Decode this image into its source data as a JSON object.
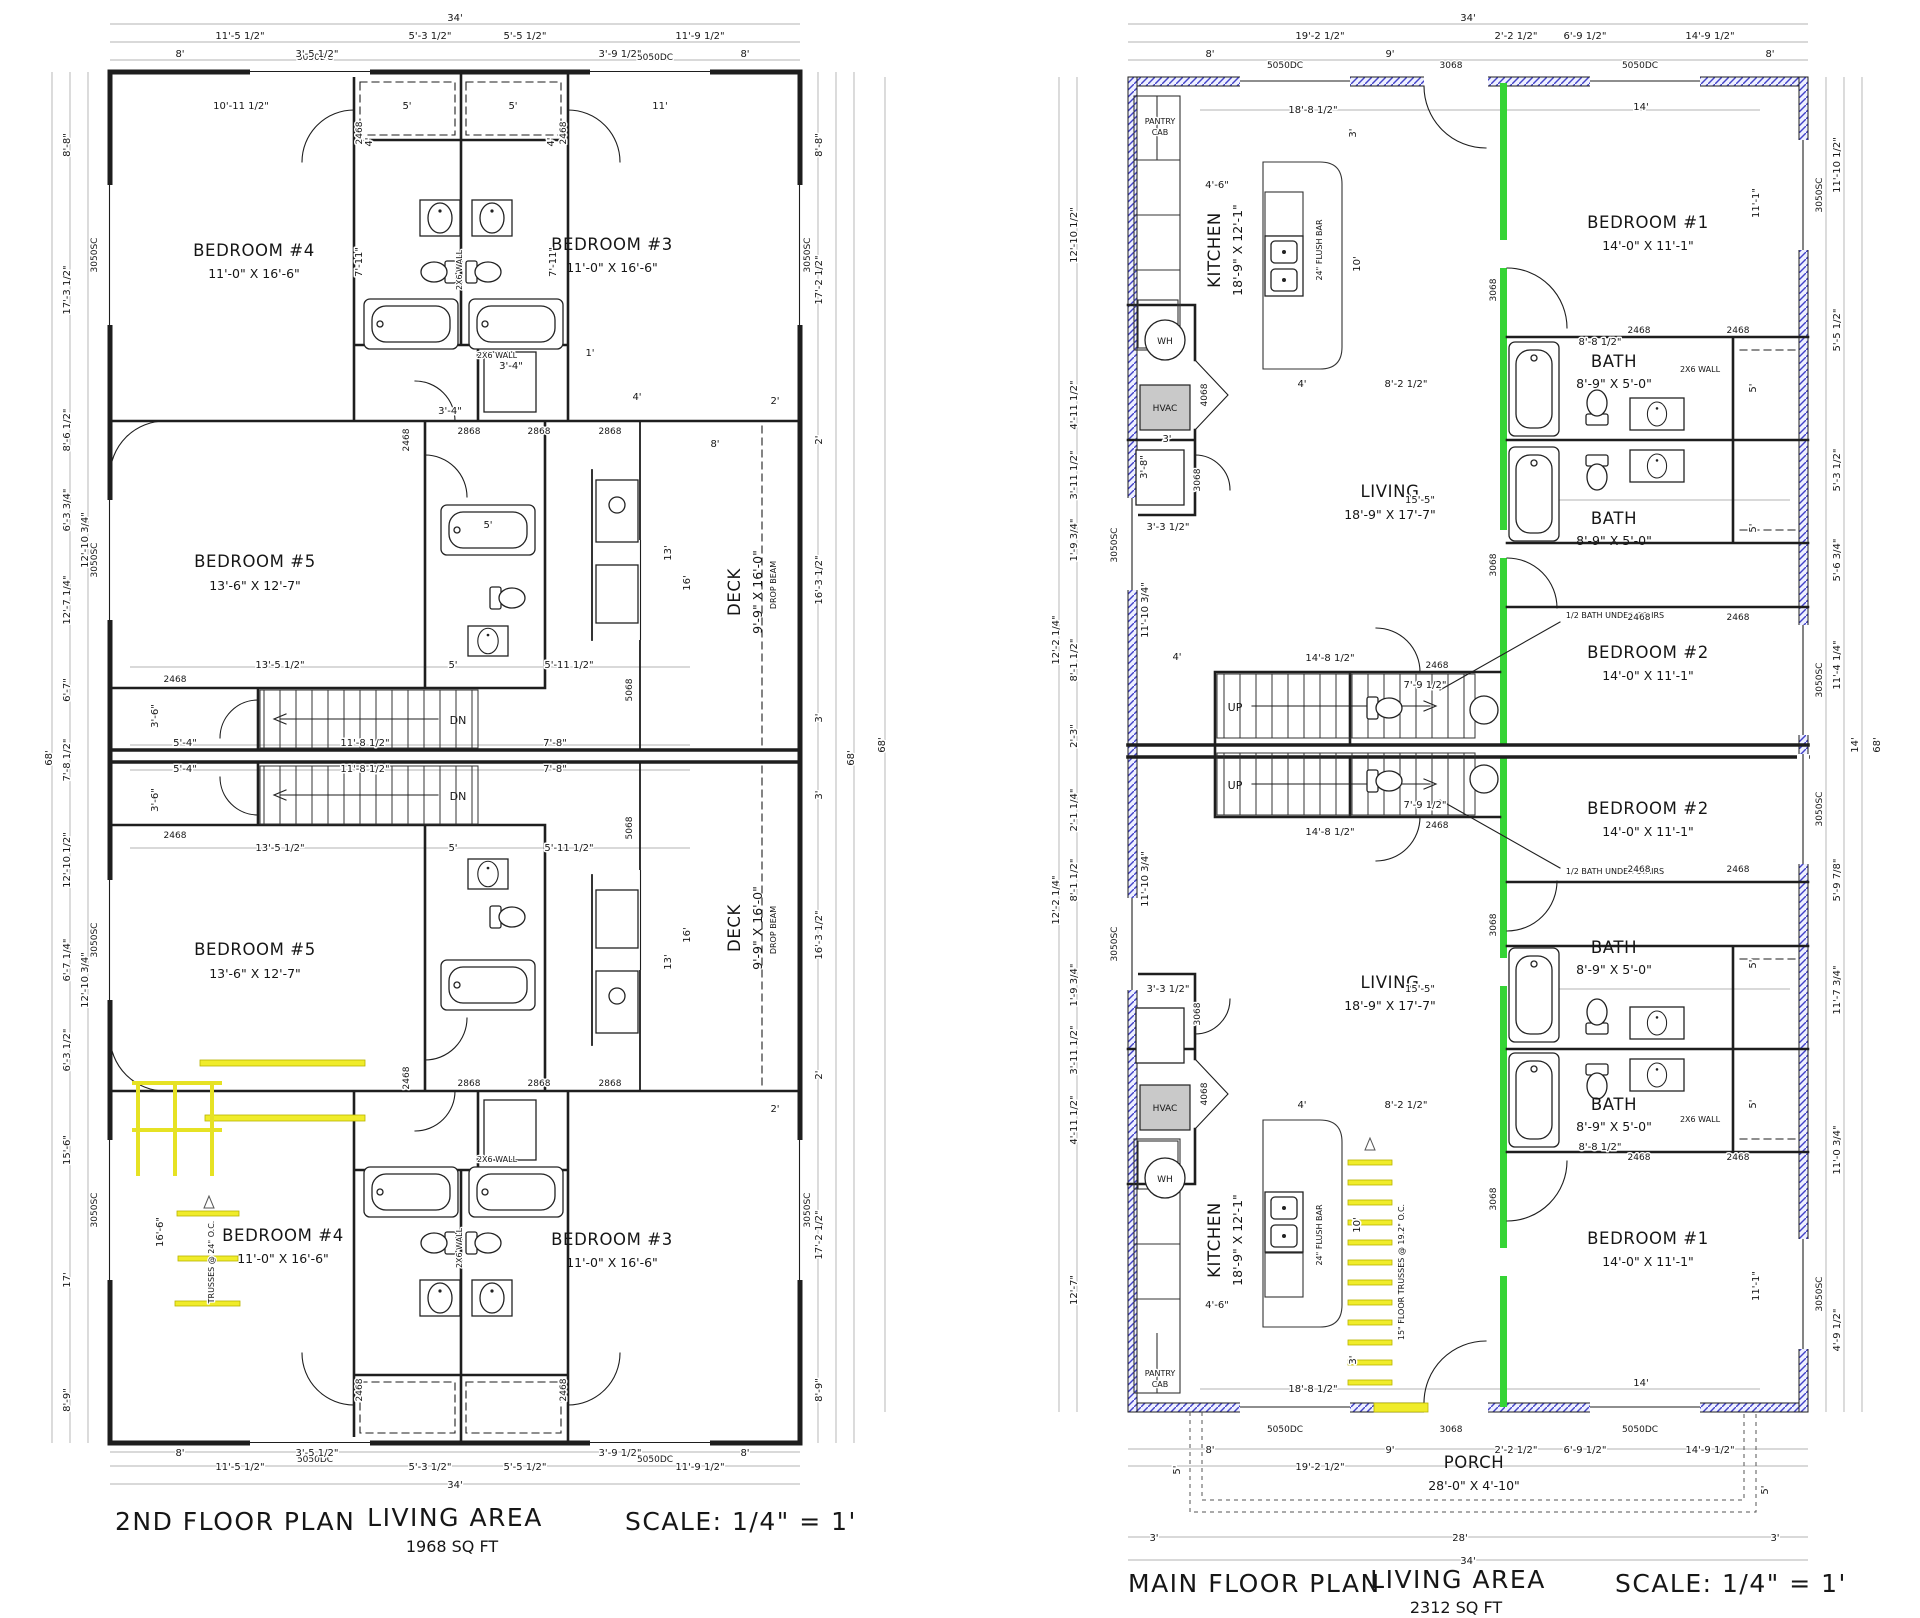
{
  "left_plan": {
    "title": "2ND FLOOR PLAN",
    "area_label": "LIVING AREA",
    "area_value": "1968 SQ FT",
    "scale_label": "SCALE: 1/4\" = 1'",
    "stairs_label": "DN",
    "rooms": {
      "bed4": {
        "name": "BEDROOM #4",
        "size": "11'-0\" X 16'-6\""
      },
      "bed3": {
        "name": "BEDROOM #3",
        "size": "11'-0\" X 16'-6\""
      },
      "bed5": {
        "name": "BEDROOM #5",
        "size": "13'-6\" X 12'-7\""
      },
      "deck": {
        "name": "DECK",
        "size": "9'-9\" X 16'-0\""
      }
    },
    "notes": {
      "wall2x6": "2X6 WALL",
      "drop_beam": "DROP BEAM",
      "truss": "TRUSSES @ 24\" O.C."
    }
  },
  "right_plan": {
    "title": "MAIN FLOOR PLAN",
    "area_label": "LIVING AREA",
    "area_value": "2312 SQ FT",
    "scale_label": "SCALE: 1/4\" = 1'",
    "stairs_label": "UP",
    "rooms": {
      "kitchen": {
        "name": "KITCHEN",
        "size": "18'-9\" X 12'-1\""
      },
      "living": {
        "name": "LIVING",
        "size": "18'-9\" X 17'-7\""
      },
      "bed1": {
        "name": "BEDROOM #1",
        "size": "14'-0\" X 11'-1\""
      },
      "bed2": {
        "name": "BEDROOM #2",
        "size": "14'-0\" X 11'-1\""
      },
      "bath": {
        "name": "BATH",
        "size": "8'-9\" X 5'-0\""
      },
      "porch": {
        "name": "PORCH",
        "size": "28'-0\" X 4'-10\""
      }
    },
    "notes": {
      "half_bath": "1/2 BATH UNDER STAIRS",
      "pantry_line1": "PANTRY",
      "pantry_line2": "CAB",
      "flush_bar": "24\" FLUSH BAR",
      "hvac": "HVAC",
      "wh": "WH",
      "wall2x6": "2X6 WALL",
      "truss": "15\" FLOOR TRUSSES @ 19.2\" O.C."
    }
  },
  "codes": {
    "w5050": "5050DC",
    "w3050": "3050SC",
    "d3068": "3068",
    "d2468": "2468",
    "d2868": "2868",
    "d5068": "5068",
    "d4068": "4068"
  },
  "dims": {
    "ft34": "34'",
    "ft68": "68'",
    "ft28": "28'",
    "ft8": "8'",
    "ft9": "9'",
    "ft5": "5'",
    "ft4": "4'",
    "ft3": "3'",
    "ft2": "2'",
    "ft1": "1'",
    "ft10": "10'",
    "ft11": "11'",
    "ft13": "13'",
    "ft14": "14'",
    "ft16": "16'",
    "ft17": "17'",
    "d11_5h": "11'-5 1/2\"",
    "d5_3h": "5'-3 1/2\"",
    "d5_5h": "5'-5 1/2\"",
    "d11_9h": "11'-9 1/2\"",
    "d3_5h": "3'-5 1/2\"",
    "d3_9h": "3'-9 1/2\"",
    "d10_11h": "10'-11 1/2\"",
    "d7_11": "7'-11\"",
    "d3_4": "3'-4\"",
    "d13_5h": "13'-5 1/2\"",
    "d5_11h": "5'-11 1/2\"",
    "d5_4": "5'-4\"",
    "d11_8h": "11'-8 1/2\"",
    "d7_8": "7'-8\"",
    "d3_6": "3'-6\"",
    "d16_3h": "16'-3 1/2\"",
    "d17_2h": "17'-2 1/2\"",
    "d8_8": "8'-8\"",
    "d8_9": "8'-9\"",
    "d17_3h": "17'-3 1/2\"",
    "d8_6h": "8'-6 1/2\"",
    "d6_3t": "6'-3 3/4\"",
    "d12_7q": "12'-7 1/4\"",
    "d6_7": "6'-7\"",
    "d12_10t": "12'-10 3/4\"",
    "d7_8h": "7'-8 1/2\"",
    "d15_6": "15'-6\"",
    "d6_7q": "6'-7 1/4\"",
    "d8_3": "8'-3\"",
    "d12_10h": "12'-10 1/2\"",
    "d6_3h": "6'-3 1/2\"",
    "d16_6": "16'-6\"",
    "d19_2h": "19'-2 1/2\"",
    "d2_2h": "2'-2 1/2\"",
    "d6_9h": "6'-9 1/2\"",
    "d14_9h": "14'-9 1/2\"",
    "d18_8h": "18'-8 1/2\"",
    "d4_6": "4'-6\"",
    "d8_2h": "8'-2 1/2\"",
    "d11_1": "11'-1\"",
    "d15_5": "15'-5\"",
    "d3_3h": "3'-3 1/2\"",
    "d11_10t": "11'-10 3/4\"",
    "d14_8h": "14'-8 1/2\"",
    "d7_9h": "7'-9 1/2\"",
    "d8_8h": "8'-8 1/2\"",
    "d3_8": "3'-8\"",
    "d4_11h": "4'-11 1/2\"",
    "d3_11h": "3'-11 1/2\"",
    "d1_9t": "1'-9 3/4\"",
    "d12_2q": "12'-2 1/4\"",
    "d8_1h": "8'-1 1/2\"",
    "d2_1q": "2'-1 1/4\"",
    "d12_7": "12'-7\"",
    "d5_6t": "5'-6 3/4\"",
    "d11_4q": "11'-4 1/4\"",
    "d5_9e": "5'-9 7/8\"",
    "d11_7t": "11'-7 3/4\"",
    "d11_0t": "11'-0 3/4\"",
    "d4_9h": "4'-9 1/2\"",
    "d2_3": "2'-3\"",
    "d11_10h": "11'-10 1/2\""
  },
  "colors": {
    "exterior_wall_hatch": "#4242c8",
    "unit_separation_wall": "#35d435",
    "truss_highlight": "#f0ec2a",
    "hvac_fill": "#c9c9c9",
    "line": "#1e1e1e"
  }
}
